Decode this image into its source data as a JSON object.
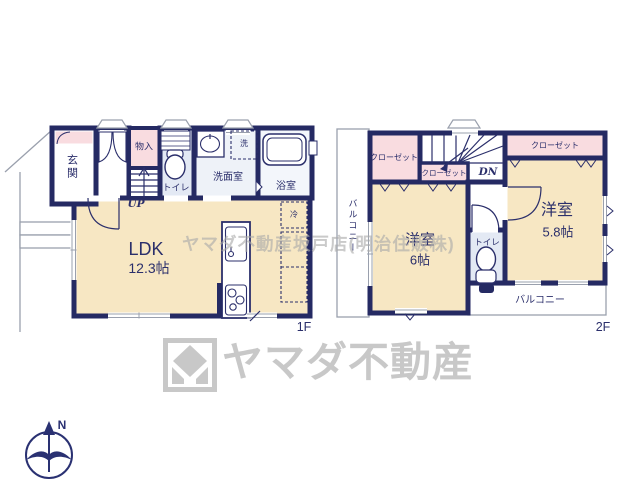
{
  "colors": {
    "wall_navy": "#252a63",
    "text_navy": "#2b2f6b",
    "room_cream": "#f7e7c3",
    "closet_pink": "#f9dce0",
    "water_blue": "#e3e9f4",
    "washroom_white": "#eef2f8",
    "watermark_gray": "#bdbdbd",
    "logo_gray": "#c8c8c8"
  },
  "floor1": {
    "label": "1F",
    "rooms": {
      "genkan": "玄関",
      "monoire": "物入",
      "stairs_up": "UP",
      "toilet": "トイレ",
      "washroom": "洗面室",
      "washer": "洗",
      "bath": "浴室",
      "ldk_name": "LDK",
      "ldk_size": "12.3帖",
      "fridge": "冷"
    }
  },
  "floor2": {
    "label": "2F",
    "rooms": {
      "closet_left": "クローゼット",
      "closet_mid": "クローゼット",
      "closet_right": "クローゼット",
      "stairs_down": "DN",
      "bedroom_6_name": "洋室",
      "bedroom_6_size": "6帖",
      "bedroom_58_name": "洋室",
      "bedroom_58_size": "5.8帖",
      "toilet": "トイレ",
      "balcony_side": "バルコニー",
      "balcony_bottom": "バルコニー"
    }
  },
  "watermark": "ヤマダ不動産坂戸店(明治住販株)",
  "logo": {
    "company": "ヤマダ不動産"
  },
  "compass": {
    "north": "N"
  }
}
